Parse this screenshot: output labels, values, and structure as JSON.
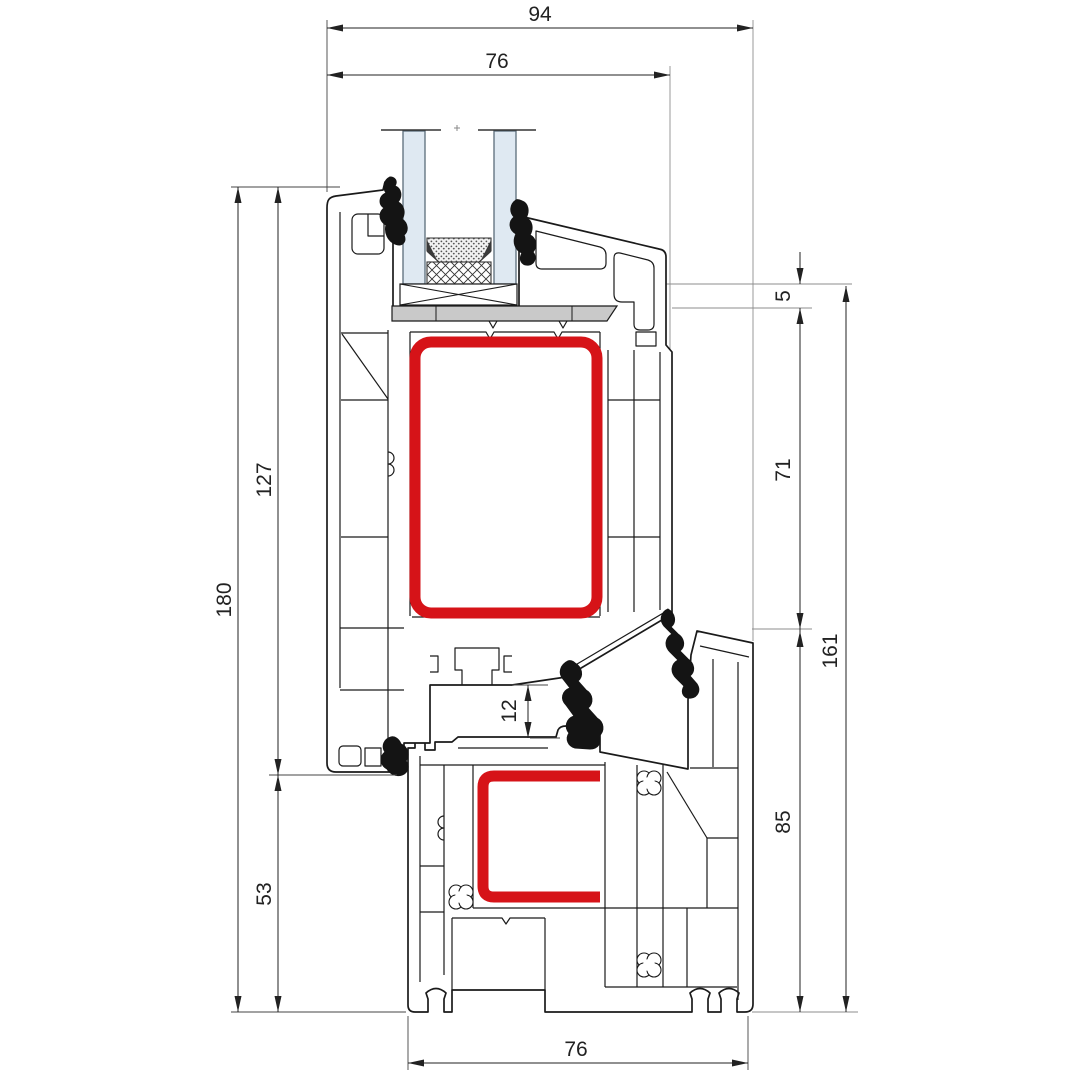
{
  "drawing": {
    "title": "PVC window profile cross-section (sash over frame) with steel reinforcement",
    "dimensions": {
      "d94": "94",
      "d76_top": "76",
      "d180": "180",
      "d127": "127",
      "d53": "53",
      "d5": "5",
      "d71": "71",
      "d161": "161",
      "d85": "85",
      "d12": "12",
      "d76_bottom": "76"
    },
    "colors": {
      "steel_reinforcement": "#d61318",
      "glass_fill": "#dfe9f2",
      "glass_edge": "#5b6c79",
      "glazing_bridge": "#c9c9c9",
      "gasket": "#141414",
      "outline": "#1a1a1a"
    }
  }
}
